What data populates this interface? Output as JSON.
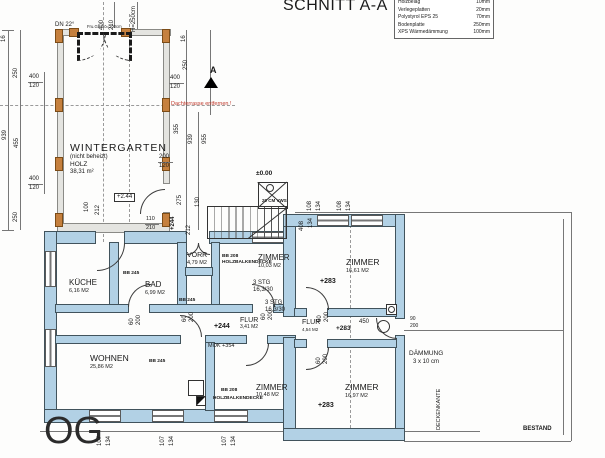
{
  "header": {
    "title": "SCHNITT A-A",
    "legend": [
      {
        "material": "Holzbelag",
        "thickness": "10mm"
      },
      {
        "material": "Verlegeplatten",
        "thickness": "20mm"
      },
      {
        "material": "Polystyrol EPS 25",
        "thickness": "70mm"
      },
      {
        "material": "Bodenplatte",
        "thickness": "250mm"
      },
      {
        "material": "XPS Wärmedämmung",
        "thickness": "100mm"
      }
    ]
  },
  "floor_label": "OG",
  "rooms": {
    "wintergarten": {
      "name": "WINTERGARTEN",
      "note": "(nicht beheizt)",
      "material": "HOLZ",
      "area": "38,31 m²"
    },
    "kueche": {
      "name": "KÜCHE",
      "area": "6,16 M2"
    },
    "bad": {
      "name": "BAD",
      "area": "6,99 M2"
    },
    "vorr": {
      "name": "VORR",
      "area": "4,79 M2"
    },
    "zimmer_nord": {
      "name": "ZIMMER",
      "area": "10,03 M2"
    },
    "wohnen": {
      "name": "WOHNEN",
      "area": "25,86 M2"
    },
    "zimmer_sued": {
      "name": "ZIMMER",
      "area": "10,48 M2"
    },
    "flur_west": {
      "name": "FLUR",
      "area": "3,41 M2"
    },
    "flur_ost": {
      "name": "FLUR",
      "area": "4,54 M2"
    },
    "zimmer_ost_oben": {
      "name": "ZIMMER",
      "area": "16,61 M2"
    },
    "zimmer_ost_unten": {
      "name": "ZIMMER",
      "area": "16,97 M2"
    }
  },
  "levels": {
    "zero": "±0.00",
    "wg_boxed": "+2.44",
    "og": "+244",
    "og_ost": "+283",
    "mok": "MOK +354"
  },
  "notes": {
    "red_note": "Dachterrasse entfernen !",
    "dn": "DN 22°",
    "parapet": "Fru.Ge.Hö=100cm",
    "vws": "20 CM VWS",
    "bb245": "BB 245",
    "bb208": "BB 208",
    "decke": "HOLZBALKENDECKE",
    "stg": "3 STG",
    "stg_size": "16,3/30",
    "daemmung_1": "DÄMMUNG",
    "daemmung_2": "3 x 10 cm",
    "deckenkante": "DECKENKANTE",
    "bestand": "BESTAND",
    "section_marker": "A"
  },
  "dims": {
    "d16": "16",
    "d60": "60",
    "d90": "90",
    "d100": "100",
    "d107": "107",
    "d108": "108",
    "d110": "110",
    "d120": "120",
    "d130": "130",
    "d134": "134",
    "d200": "200",
    "d210": "210",
    "d212": "212",
    "d250": "250",
    "d275": "275",
    "d355": "355",
    "d400": "400",
    "d408": "408",
    "d450": "450",
    "d455": "455",
    "d939": "939",
    "d955": "955",
    "h250": "H=250cm"
  }
}
